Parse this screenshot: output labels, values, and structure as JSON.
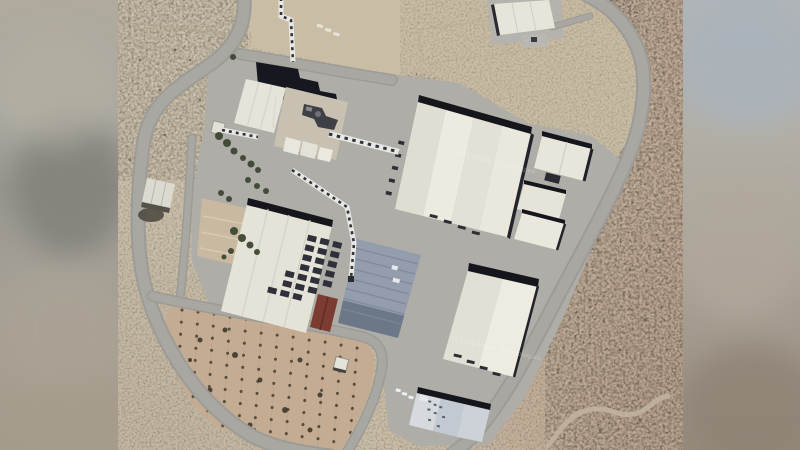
{
  "image": {
    "kind": "satellite-photo",
    "description": "Overhead satellite view of a desert industrial facility: large white warehouses connected by conveyor bridges, a blue solar-panel roof, a perimeter loop road, an orchard plot at lower left, and blurred letterbox bars on both sides.",
    "watermark": "© 2023 Maxar Technologies"
  },
  "palette": {
    "desert_base": "#c9bda7",
    "desert_east": "#c2ad98",
    "orchard_soil": "#c4ac93",
    "road": "#a8a7a1",
    "road_dark": "#9c9b95",
    "apron": "#aeada7",
    "roof_white": "#e9e7dc",
    "shadow_dark": "#15151c",
    "concrete": "#c8c1b1",
    "solar_blue": "#939dab",
    "solar_dark": "#6c7787",
    "canopy_blue": "#c6ccd2",
    "maroon": "#7d3c31",
    "tree_green": "#3d4732",
    "bar_blue_top": "#aeb4b9",
    "bar_tan": "#a89f92"
  },
  "features": [
    "perimeter-road",
    "main-warehouse",
    "production-hall",
    "process-tower",
    "conveyor-bridges",
    "solar-roof-building",
    "south-warehouse",
    "parking-canopy",
    "orchard-field",
    "desert-terrain"
  ]
}
